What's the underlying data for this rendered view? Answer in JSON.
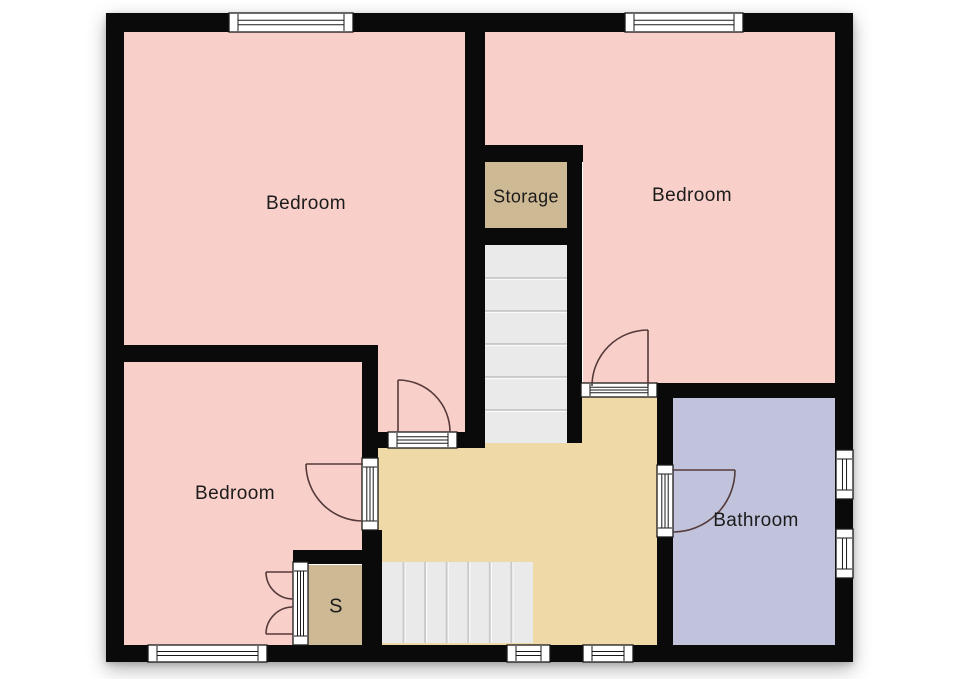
{
  "plan": {
    "canvas": {
      "width": 960,
      "height": 679,
      "background": "#ffffff"
    },
    "bounds": {
      "x": 106,
      "y": 13,
      "w": 747,
      "h": 649
    },
    "palette": {
      "wall": "#0a0a0a",
      "bedroom_fill": "#f9cfc9",
      "hallway_fill": "#eed9a7",
      "storage_fill": "#cdb994",
      "bathroom_fill": "#c1c3dc",
      "stairs_fill": "#eaeaea",
      "stairs_divider": "#c9c9c9",
      "stairs_highlight": "#fafafa",
      "frame_fill": "#ffffff",
      "frame_stroke": "#1a1a1a",
      "door_arc": "#553a3a",
      "label_color": "#1b1b1b"
    },
    "rooms": [
      {
        "id": "bedroom-top-left",
        "label": "Bedroom",
        "fill_key": "bedroom_fill",
        "polygon": [
          [
            124,
            32
          ],
          [
            465,
            32
          ],
          [
            465,
            432
          ],
          [
            377,
            432
          ],
          [
            377,
            345
          ],
          [
            124,
            345
          ]
        ],
        "label_pos": [
          306,
          204
        ],
        "font_size": 19
      },
      {
        "id": "bedroom-top-right",
        "label": "Bedroom",
        "fill_key": "bedroom_fill",
        "polygon": [
          [
            485,
            32
          ],
          [
            835,
            32
          ],
          [
            835,
            383
          ],
          [
            583,
            383
          ],
          [
            583,
            145
          ],
          [
            485,
            145
          ]
        ],
        "label_pos": [
          692,
          196
        ],
        "font_size": 19
      },
      {
        "id": "bedroom-bottom-left",
        "label": "Bedroom",
        "fill_key": "bedroom_fill",
        "polygon": [
          [
            124,
            362
          ],
          [
            362,
            362
          ],
          [
            362,
            550
          ],
          [
            293,
            550
          ],
          [
            293,
            645
          ],
          [
            124,
            645
          ]
        ],
        "label_pos": [
          235,
          494
        ],
        "font_size": 19
      },
      {
        "id": "storage",
        "label": "Storage",
        "fill_key": "storage_fill",
        "polygon": [
          [
            485,
            162
          ],
          [
            567,
            162
          ],
          [
            567,
            228
          ],
          [
            485,
            228
          ]
        ],
        "label_pos": [
          526,
          197
        ],
        "font_size": 18
      },
      {
        "id": "closet-s",
        "label": "S",
        "fill_key": "storage_fill",
        "polygon": [
          [
            308,
            565
          ],
          [
            365,
            565
          ],
          [
            365,
            645
          ],
          [
            308,
            645
          ]
        ],
        "label_pos": [
          336,
          607
        ],
        "font_size": 20
      },
      {
        "id": "bathroom",
        "label": "Bathroom",
        "fill_key": "bathroom_fill",
        "polygon": [
          [
            673,
            398
          ],
          [
            835,
            398
          ],
          [
            835,
            645
          ],
          [
            673,
            645
          ]
        ],
        "label_pos": [
          756,
          521
        ],
        "font_size": 19
      },
      {
        "id": "hallway-landing",
        "label": "",
        "fill_key": "hallway_fill",
        "polygon": [
          [
            378,
            448
          ],
          [
            485,
            448
          ],
          [
            485,
            443
          ],
          [
            567,
            443
          ],
          [
            567,
            397
          ],
          [
            657,
            397
          ],
          [
            657,
            645
          ],
          [
            378,
            645
          ]
        ],
        "label_pos": null,
        "font_size": 0
      }
    ],
    "walls": [
      {
        "id": "wall-top",
        "rect": [
          106,
          13,
          747,
          19
        ]
      },
      {
        "id": "wall-bottom",
        "rect": [
          106,
          645,
          747,
          17
        ]
      },
      {
        "id": "wall-left",
        "rect": [
          106,
          13,
          18,
          649
        ]
      },
      {
        "id": "wall-right",
        "rect": [
          835,
          13,
          18,
          649
        ]
      },
      {
        "id": "wall-mid-vertical",
        "rect": [
          465,
          32,
          20,
          416
        ]
      },
      {
        "id": "wall-storage-top",
        "rect": [
          465,
          145,
          118,
          17
        ]
      },
      {
        "id": "wall-stairwell-right",
        "rect": [
          567,
          145,
          15,
          298
        ]
      },
      {
        "id": "wall-storage-bottom",
        "rect": [
          465,
          228,
          117,
          17
        ]
      },
      {
        "id": "wall-bedrooms-divider",
        "rect": [
          106,
          345,
          271,
          17
        ]
      },
      {
        "id": "wall-hall-left-upper",
        "rect": [
          362,
          345,
          16,
          115
        ]
      },
      {
        "id": "wall-hall-left-lower",
        "rect": [
          362,
          530,
          20,
          132
        ]
      },
      {
        "id": "wall-closet-top",
        "rect": [
          293,
          550,
          89,
          14
        ]
      },
      {
        "id": "wall-door1-header",
        "rect": [
          362,
          432,
          103,
          16
        ]
      },
      {
        "id": "wall-bathroom-top",
        "rect": [
          657,
          383,
          178,
          15
        ]
      },
      {
        "id": "wall-bathroom-left-up",
        "rect": [
          657,
          383,
          16,
          82
        ]
      },
      {
        "id": "wall-bathroom-left-lo",
        "rect": [
          657,
          537,
          16,
          125
        ]
      }
    ],
    "windows": [
      {
        "id": "window-bedroom1-top",
        "rect": [
          229,
          13,
          124,
          19
        ],
        "orient": "h"
      },
      {
        "id": "window-bedroom2-top",
        "rect": [
          625,
          13,
          118,
          19
        ],
        "orient": "h"
      },
      {
        "id": "window-bedroom3-bottom",
        "rect": [
          148,
          645,
          119,
          17
        ],
        "orient": "h"
      },
      {
        "id": "window-hall-bottom-1",
        "rect": [
          507,
          645,
          43,
          17
        ],
        "orient": "h"
      },
      {
        "id": "window-hall-bottom-2",
        "rect": [
          583,
          645,
          50,
          17
        ],
        "orient": "h"
      },
      {
        "id": "window-bathroom-1",
        "rect": [
          836,
          450,
          17,
          49
        ],
        "orient": "v"
      },
      {
        "id": "window-bathroom-2",
        "rect": [
          836,
          529,
          17,
          49
        ],
        "orient": "v"
      }
    ],
    "door_frames": [
      {
        "id": "doorframe-bedroom1",
        "rect": [
          388,
          432,
          69,
          16
        ],
        "orient": "h"
      },
      {
        "id": "doorframe-bedroom3",
        "rect": [
          362,
          458,
          16,
          72
        ],
        "orient": "v"
      },
      {
        "id": "doorframe-bedroom2",
        "rect": [
          581,
          383,
          76,
          14
        ],
        "orient": "h"
      },
      {
        "id": "doorframe-bathroom",
        "rect": [
          657,
          465,
          16,
          72
        ],
        "orient": "v"
      },
      {
        "id": "doorframe-closet",
        "rect": [
          293,
          562,
          15,
          83
        ],
        "orient": "v"
      }
    ],
    "door_arcs": [
      {
        "id": "door-arc-bedroom1",
        "leaf": "M398,432 L398,380",
        "arc": "M398,380 A52,52 0 0 1 450,432"
      },
      {
        "id": "door-arc-bedroom3",
        "leaf": "M363,464 L306,464",
        "arc": "M306,464 A57,57 0 0 0 363,521"
      },
      {
        "id": "door-arc-bedroom2",
        "leaf": "M648,386 L648,330",
        "arc": "M648,330 A56,56 0 0 0 592,386"
      },
      {
        "id": "door-arc-bathroom",
        "leaf": "M673,470 L735,470",
        "arc": "M735,470 A62,62 0 0 1 673,532"
      },
      {
        "id": "door-arc-closet-top",
        "leaf": "M293,572 L266,572",
        "arc": "M266,572 A27,27 0 0 0 293,599"
      },
      {
        "id": "door-arc-closet-bottom",
        "leaf": "M293,634 L266,634",
        "arc": "M266,634 A27,27 0 0 1 293,607"
      }
    ],
    "stairs": [
      {
        "id": "stairs-upper-flight",
        "rect": [
          485,
          245,
          82,
          198
        ],
        "dir": "v",
        "steps": 6
      },
      {
        "id": "stairs-lower-flight",
        "rect": [
          382,
          562,
          151,
          81
        ],
        "dir": "h",
        "steps": 7
      }
    ]
  }
}
